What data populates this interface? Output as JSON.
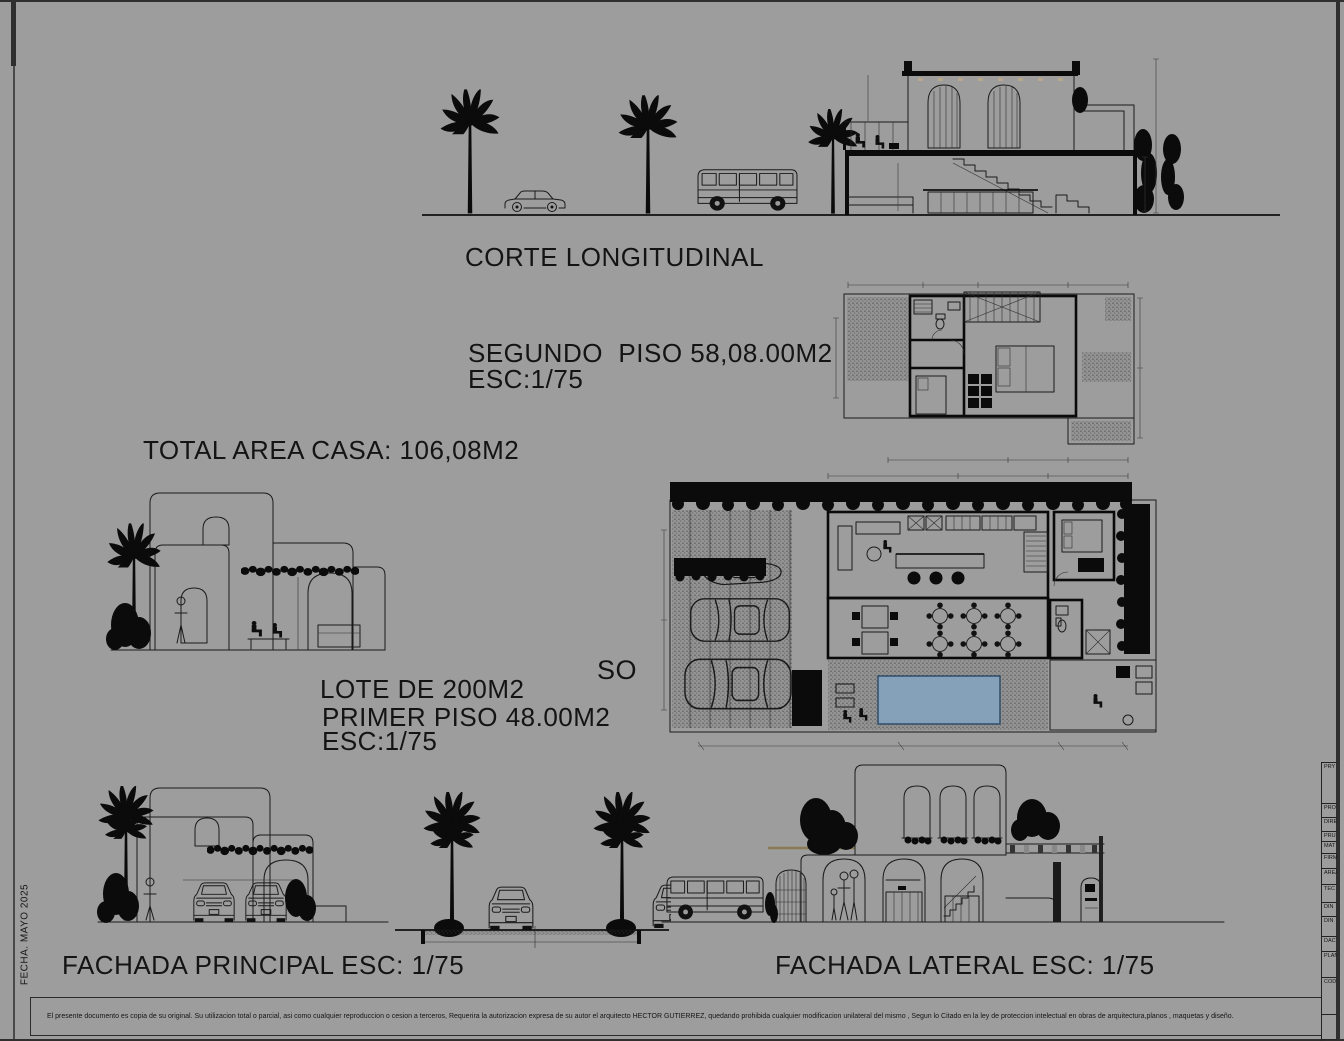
{
  "sheet": {
    "background": "#9d9d9d",
    "ink": "#1a1a1a",
    "pool_color": "#84a1b9",
    "fecha_vertical": "FECHA. MAYO 2025",
    "disclaimer": "El presente documento es copia de su original.  Su utilizacion total o parcial, asi como cualquier reproduccion o cesion a terceros, Requerira la autorizacion expresa de su autor el arquitecto HECTOR GUTIERREZ, quedando prohibida cualquier modificacion unilateral del mismo , Segun lo Citado en la ley de proteccion intelectual en obras de arquitectura,planos , maquetas y diseño."
  },
  "labels": {
    "corte": "CORTE LONGITUDINAL",
    "segundo_piso": "SEGUNDO  PISO 58,08.00M2",
    "segundo_esc": "ESC:1/75",
    "total_area": "TOTAL AREA CASA: 106,08M2",
    "lote": "LOTE DE 200M2",
    "primer_piso": "PRIMER PISO 48.00M2",
    "primer_esc": "ESC:1/75",
    "primer_partial": "SO",
    "fachada_principal": "FACHADA PRINCIPAL ESC: 1/75",
    "fachada_lateral": "FACHADA LATERAL ESC: 1/75"
  },
  "titleblock": {
    "rows": [
      "PRY",
      "PRO",
      "DIRE",
      "PRU",
      "MAT",
      "FIRM",
      "AREA",
      "TEC",
      "DIN",
      "DIN",
      "DAC",
      "PLAN",
      "COD",
      "",
      ""
    ]
  }
}
